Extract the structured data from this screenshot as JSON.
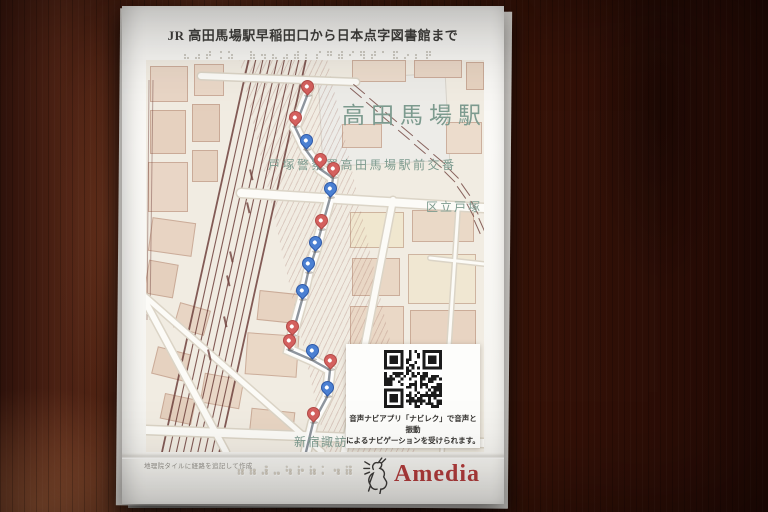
{
  "title": {
    "text": "JR 高田馬場駅早稲田口から日本点字図書館まで"
  },
  "map": {
    "labels": {
      "station": "高田馬場駅",
      "police_box": "戸塚警察署高田馬場駅前交番",
      "ward": "区立戸塚",
      "shrine": "新宿諏訪"
    },
    "colors": {
      "label_teal": "#7d9b8f",
      "railway": "#6f413c",
      "pin_red": "#d4605e",
      "pin_red_border": "#b24a47",
      "pin_blue": "#4b80d2",
      "pin_blue_border": "#2e59a8",
      "route_gray": "#8f969e"
    },
    "pins": [
      {
        "x": 161,
        "y": 36,
        "color": "red"
      },
      {
        "x": 149,
        "y": 67,
        "color": "red"
      },
      {
        "x": 160,
        "y": 90,
        "color": "blue"
      },
      {
        "x": 174,
        "y": 109,
        "color": "red"
      },
      {
        "x": 187,
        "y": 118,
        "color": "red"
      },
      {
        "x": 184,
        "y": 138,
        "color": "blue"
      },
      {
        "x": 175,
        "y": 170,
        "color": "red"
      },
      {
        "x": 169,
        "y": 192,
        "color": "blue"
      },
      {
        "x": 162,
        "y": 213,
        "color": "blue"
      },
      {
        "x": 156,
        "y": 240,
        "color": "blue"
      },
      {
        "x": 146,
        "y": 276,
        "color": "red"
      },
      {
        "x": 143,
        "y": 290,
        "color": "red"
      },
      {
        "x": 166,
        "y": 300,
        "color": "blue"
      },
      {
        "x": 184,
        "y": 310,
        "color": "red"
      },
      {
        "x": 181,
        "y": 337,
        "color": "blue"
      },
      {
        "x": 167,
        "y": 363,
        "color": "red"
      }
    ]
  },
  "qr_panel": {
    "icon": "qr-code",
    "caption_line1": "音声ナビアプリ「ナビレク」で音声と振動",
    "caption_line2": "によるナビゲーションを受けられます。"
  },
  "footer": {
    "attribution": "地理院タイルに経路を追記して作成",
    "logo_text": "Amedia",
    "logo_icon": "goat-icon",
    "logo_color": "#b23c3c"
  }
}
